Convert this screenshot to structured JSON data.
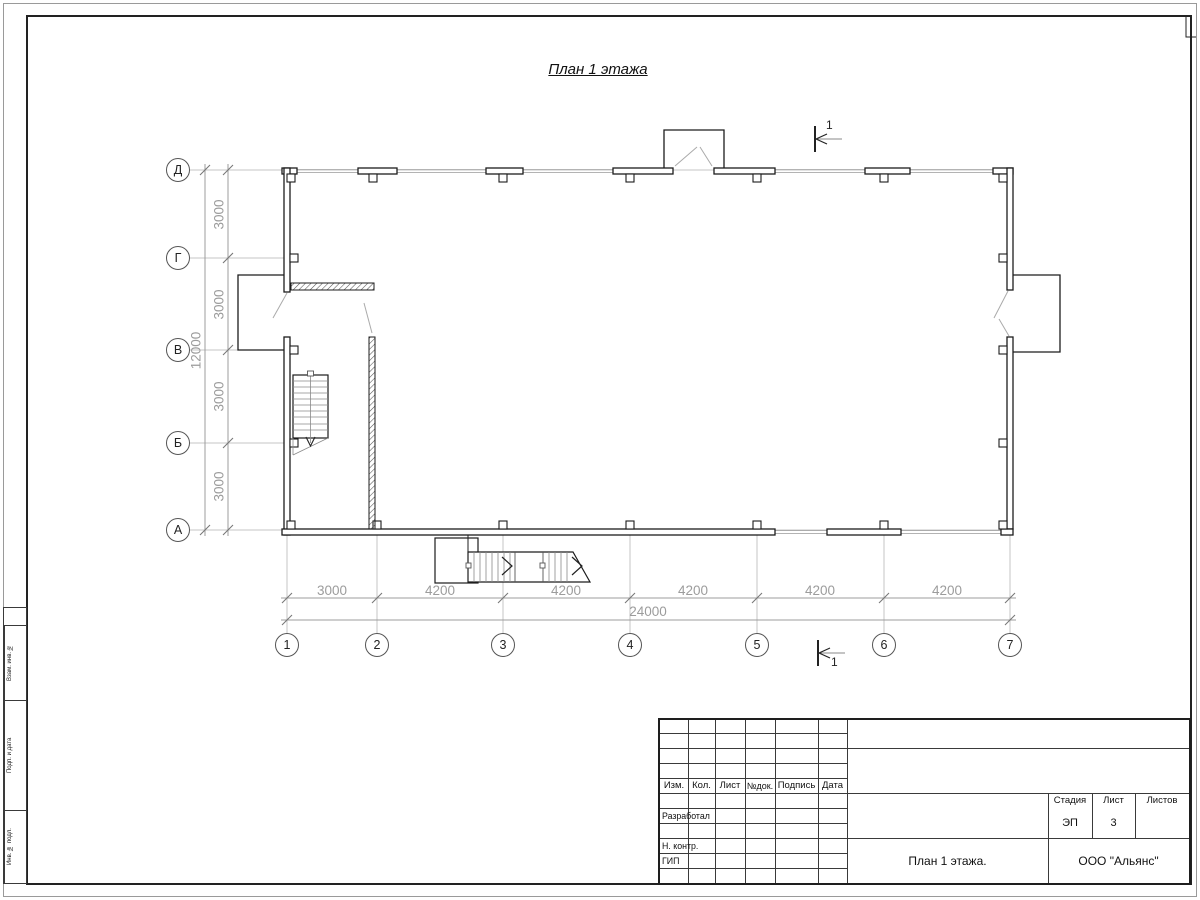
{
  "sheet": {
    "drawing_title": "План 1 этажа",
    "section_mark_top": "1",
    "section_mark_bottom": "1"
  },
  "grid": {
    "rows": [
      "Д",
      "Г",
      "В",
      "Б",
      "А"
    ],
    "columns": [
      "1",
      "2",
      "3",
      "4",
      "5",
      "6",
      "7"
    ]
  },
  "dimensions": {
    "left_segments": [
      "3000",
      "3000",
      "3000",
      "3000"
    ],
    "left_total": "12000",
    "bottom_segments": [
      "3000",
      "4200",
      "4200",
      "4200",
      "4200",
      "4200"
    ],
    "bottom_total": "24000"
  },
  "title_block": {
    "header_columns": [
      "Изм.",
      "Кол.",
      "Лист",
      "№док.",
      "Подпись",
      "Дата"
    ],
    "row_developed": "Разработал",
    "row_ncontrol": "Н. контр.",
    "row_gip": "ГИП",
    "stage_label": "Стадия",
    "sheet_label": "Лист",
    "sheets_label": "Листов",
    "stage_value": "ЭП",
    "sheet_value": "3",
    "sheets_value": "",
    "drawing_name": "План 1 этажа.",
    "company": "ООО \"Альянс\""
  },
  "side_stamp": {
    "labels": [
      "Взам. инв. №",
      "Подп. и дата",
      "Инв. № подл."
    ]
  },
  "colors": {
    "wall": "#1c1c1c",
    "dimension": "#9c9c9c",
    "grid_line": "#c4c4c4",
    "window": "#a8a8a8"
  }
}
